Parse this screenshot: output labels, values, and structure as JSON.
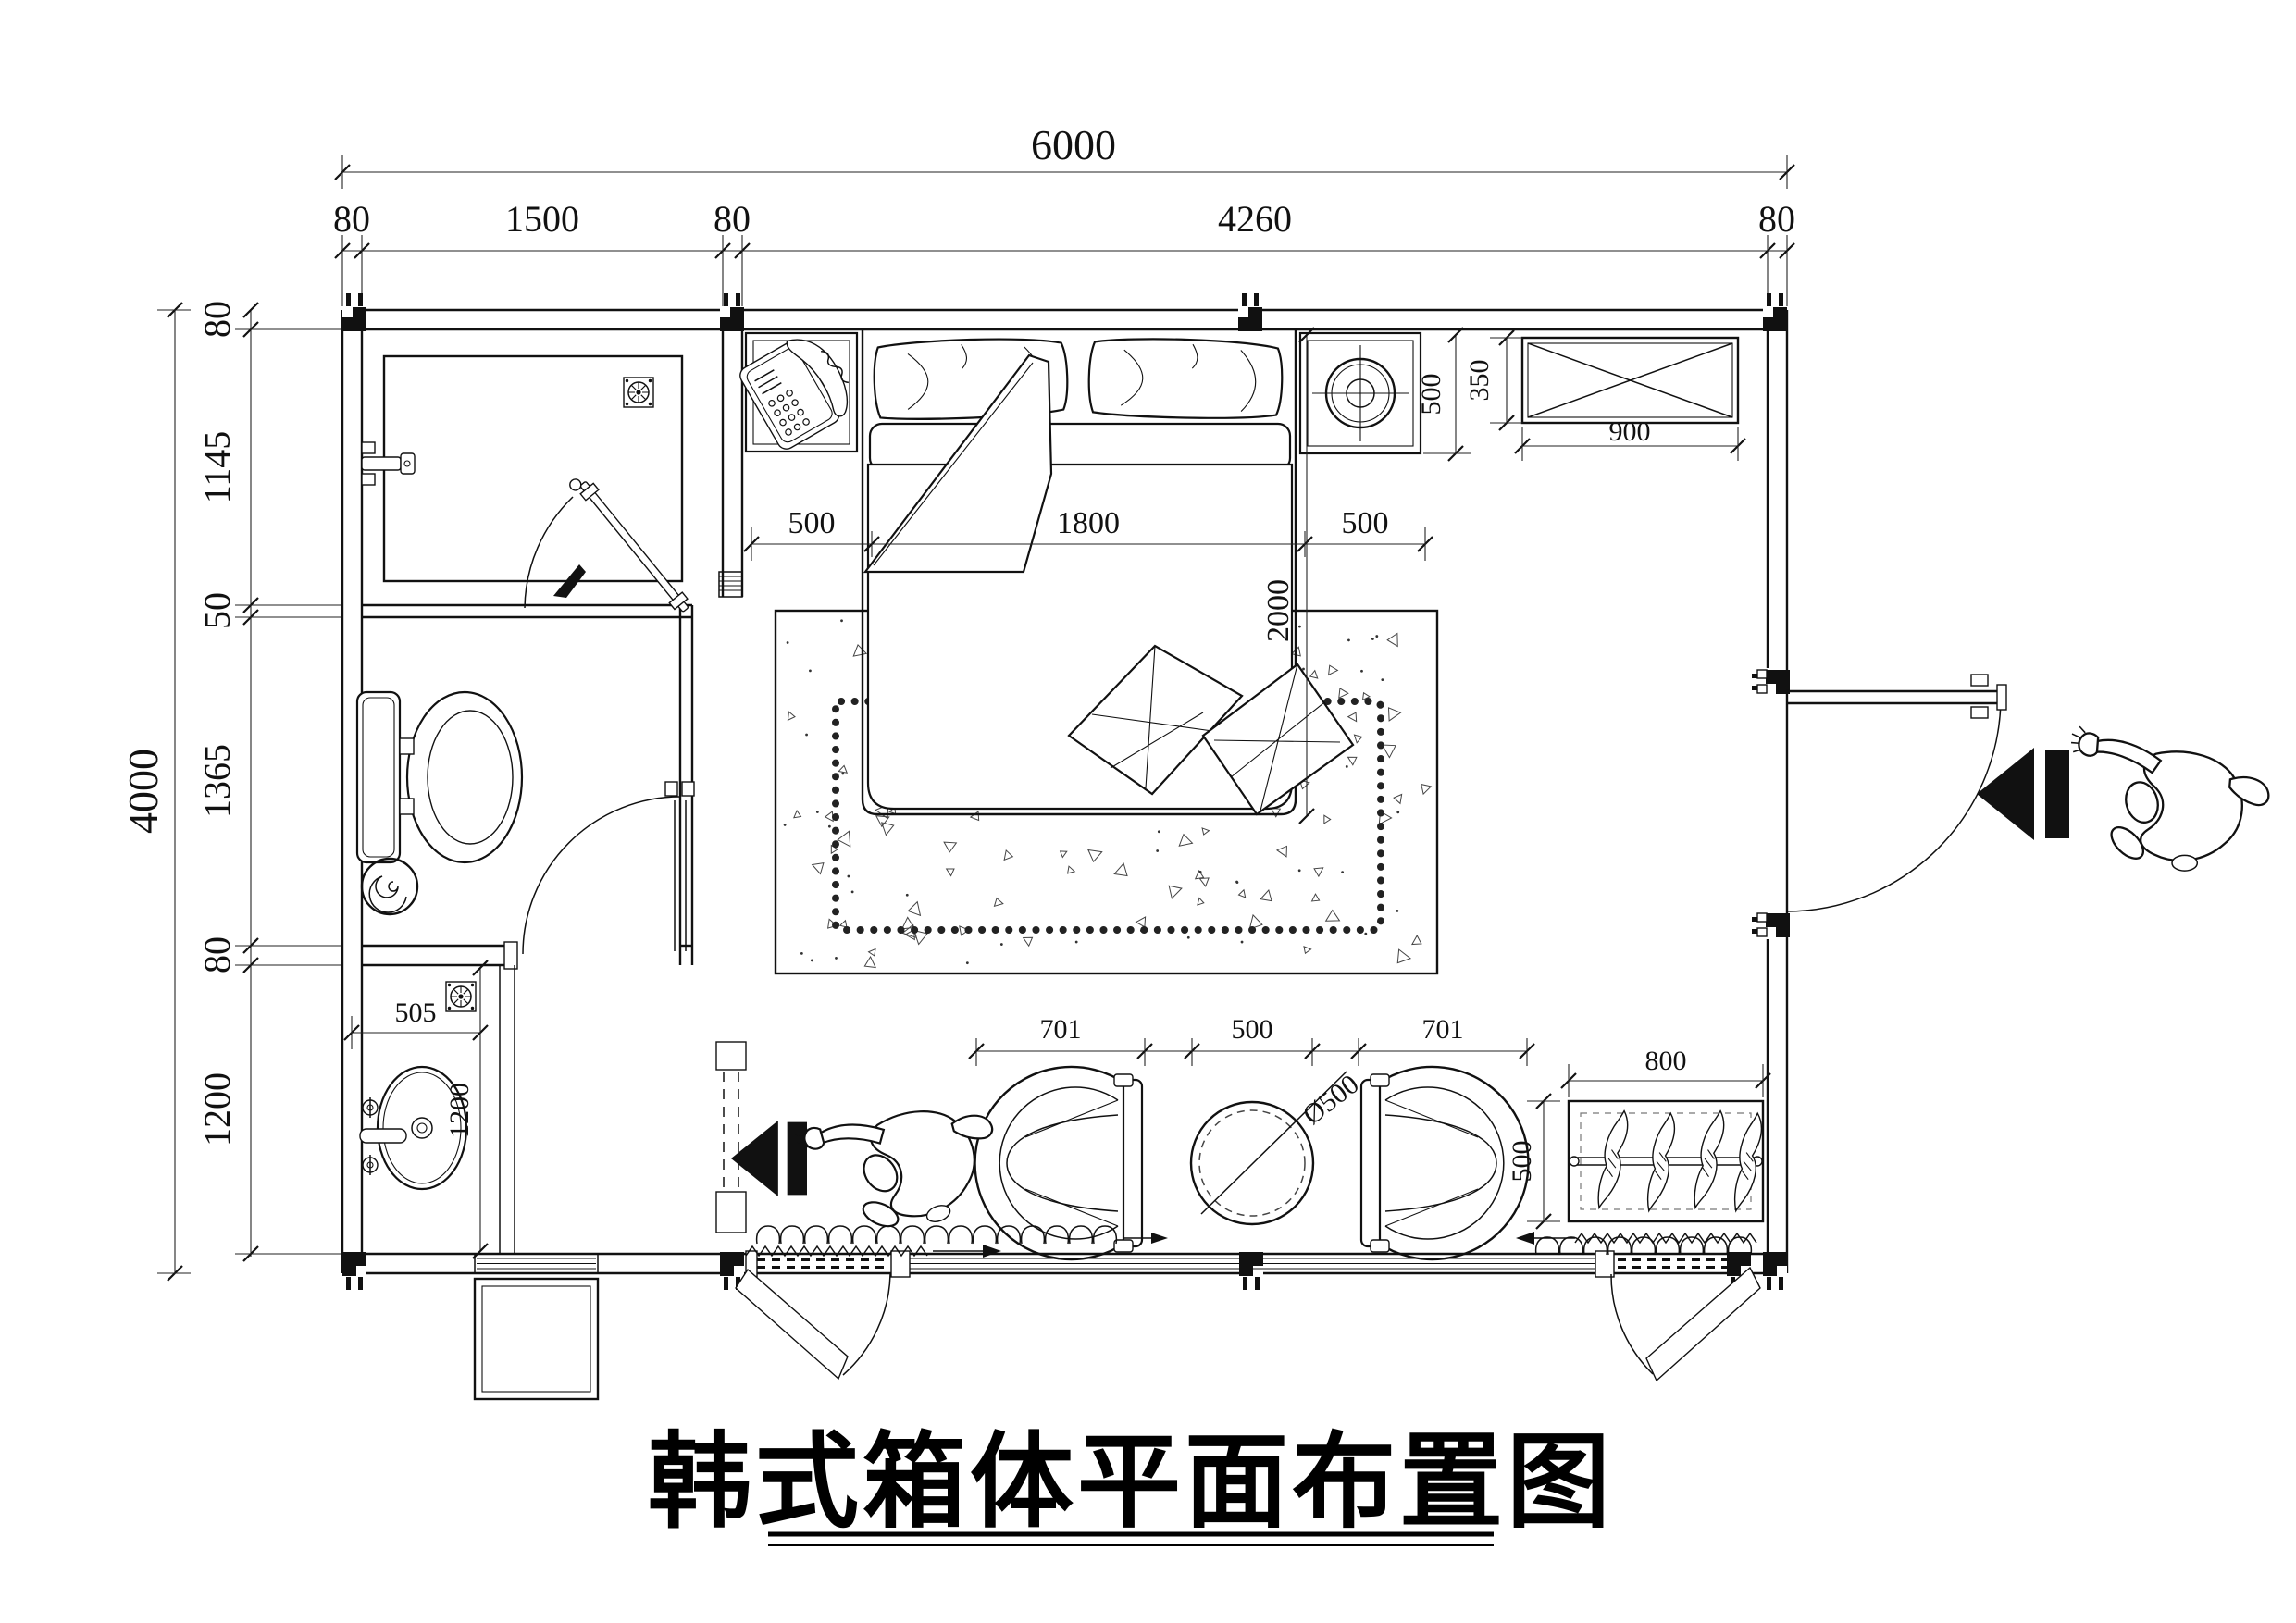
{
  "title": "韩式箱体平面布置图",
  "dims": {
    "total_w": "6000",
    "chain_top": [
      "80",
      "1500",
      "80",
      "4260",
      "80"
    ],
    "total_h": "4000",
    "chain_left": [
      "80",
      "1145",
      "50",
      "1365",
      "80",
      "1200"
    ],
    "bed_gap_left": "500",
    "bed_width": "1800",
    "bed_gap_right": "500",
    "bed_length": "2000",
    "nightstand_depth": "500",
    "cabinet_depth": "350",
    "cabinet_width": "900",
    "vanity_width": "505",
    "vanity_depth": "1200",
    "chair_left": "701",
    "table_gap": "500",
    "chair_right": "701",
    "table_diameter": "Ø500",
    "wardrobe_width": "800",
    "wardrobe_depth": "500"
  },
  "icons": {
    "floor_drain": "floor-drain-icon",
    "telephone": "telephone-icon",
    "table_lamp": "lamp-icon",
    "person": "person-top-view-icon",
    "entry_arrow": "direction-arrow-icon",
    "clothes_hanger": "hanger-icon"
  }
}
